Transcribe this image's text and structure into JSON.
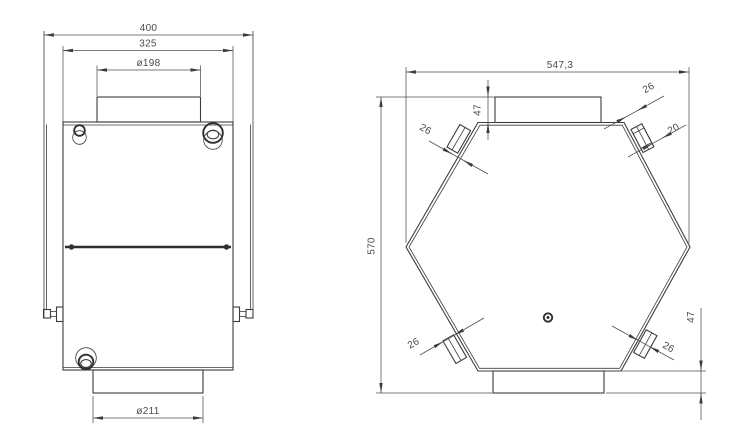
{
  "drawing": {
    "background": "#ffffff",
    "line_color": "#3d3d3d",
    "dim_color": "#4f4f4f",
    "front_view": {
      "overall_width": "400",
      "body_width": "325",
      "top_port_diameter": "ø198",
      "bottom_port_diameter": "ø211"
    },
    "top_view": {
      "overall_width": "547,3",
      "overall_height": "570",
      "top_collar_height": "47",
      "bottom_collar_height": "47",
      "port_top_left_size": "26",
      "port_top_right_size": "26",
      "port_top_right_duct": "20",
      "port_bottom_left_size": "26",
      "port_bottom_right_size": "26"
    }
  }
}
